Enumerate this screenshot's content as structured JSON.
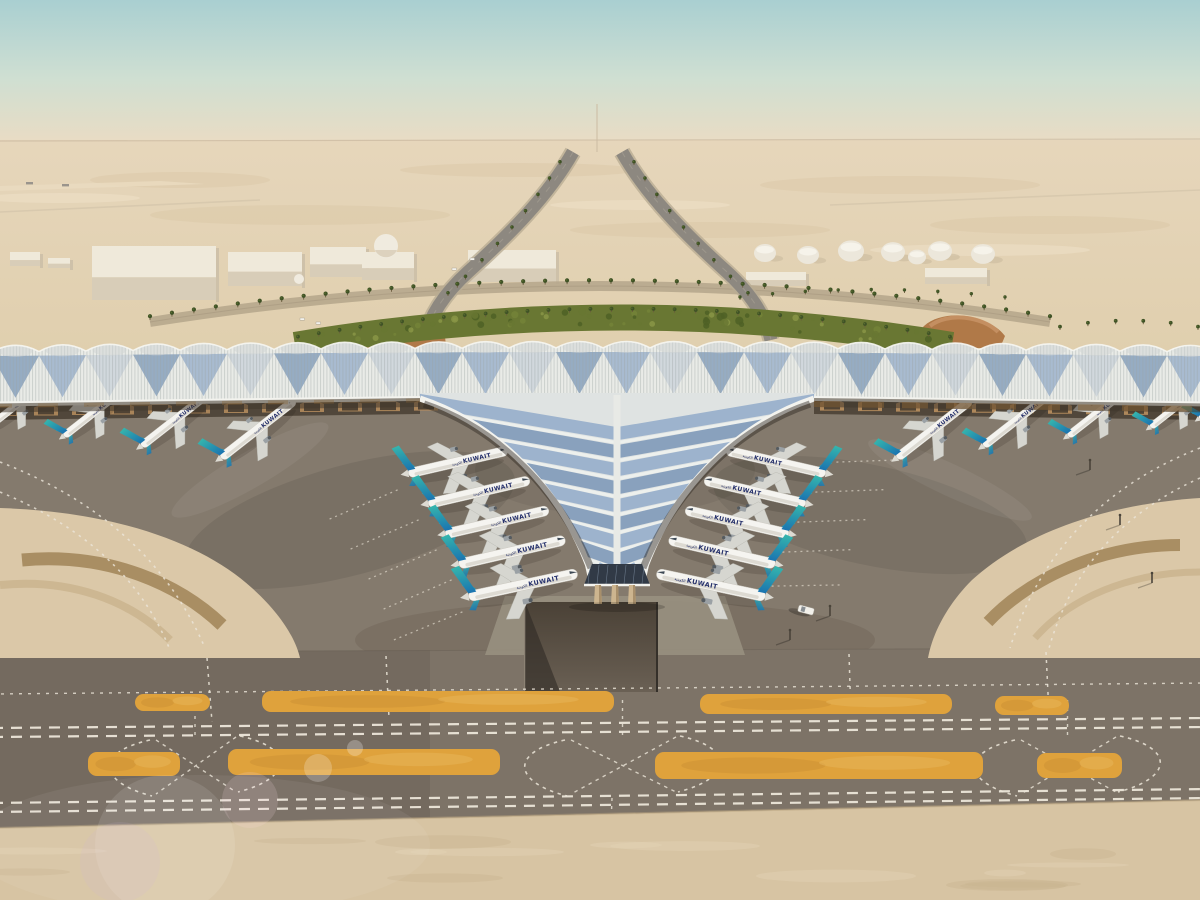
{
  "scene": {
    "description": "Aerial rendering of Kuwait International Airport trident-shaped terminal in the desert with Kuwait Airways aircraft parked at the gates",
    "aircraft_label": "KUWAIT",
    "aircraft_label_arabic": "الكويتية",
    "aircraft_count": 20
  },
  "colors": {
    "sky_top": "#a9cfd1",
    "sky_mid": "#cfdfd2",
    "horizon_haze": "#e9dcc4",
    "desert_far": "#e6d6bb",
    "desert_mid": "#e0cfae",
    "sand_side": "#dbc8a8",
    "sand_bottom": "#d7c4a3",
    "green_dark": "#4f6026",
    "green_mid": "#697733",
    "green_light": "#8a9547",
    "palm": "#3f5226",
    "palm_trunk": "#6b5b3e",
    "road_light": "#b7a78d",
    "road_dark": "#8d8880",
    "ramp_brown": "#b07948",
    "building_top": "#efe9da",
    "building_front": "#d8cdb8",
    "tank_white": "#ece7db",
    "roof_white": "#e9ebe7",
    "roof_beam": "#f3f3ee",
    "panel_blue": "#8fa8c8",
    "panel_blue_dark": "#7693b5",
    "panel_pale": "#b9c6d4",
    "rib_gray": "#9aa2a3",
    "vault_shade": "#cfd4d4",
    "eave_shadow": "#40372b",
    "eave_warm": "#8a6335",
    "facade_arch": "#b98f5f",
    "glass_dark": "#313a46",
    "column_beige": "#cdb58f",
    "apron": "#847a6d",
    "apron_dark": "#6d6458",
    "band_gray": "#7d7367",
    "marking": "#ece6d9",
    "island_yellow": "#dfa23c",
    "island_dark": "#c98f33",
    "island_light": "#e8b55a",
    "tunnel": "#4a4136",
    "fuselage": "#f5f4f0",
    "belly": "#d4d1c8",
    "tail_teal": "#35b6ad",
    "tail_blue": "#1b74b0",
    "title_navy": "#25306b",
    "wing_gray": "#d6d6d0",
    "engine_gray": "#9ba1a5",
    "vehicle_white": "#f2f0ea",
    "pole": "#4a443a"
  }
}
